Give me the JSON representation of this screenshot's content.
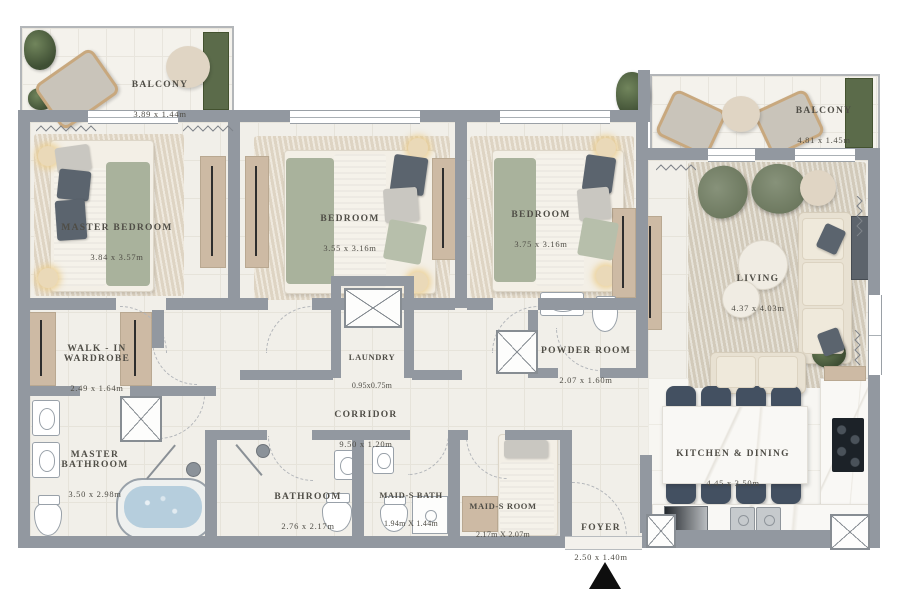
{
  "plan_type": "apartment-floor-plan",
  "rooms": {
    "balcony1": {
      "label": "BALCONY",
      "dims": "3.89 x 1.44m"
    },
    "master_bedroom": {
      "label": "MASTER BEDROOM",
      "dims": "3.84 x 3.57m"
    },
    "bedroom2": {
      "label": "BEDROOM",
      "dims": "3.55 x 3.16m"
    },
    "bedroom3": {
      "label": "BEDROOM",
      "dims": "3.75 x 3.16m"
    },
    "balcony2": {
      "label": "BALCONY",
      "dims": "4.81 x 1.45m"
    },
    "living": {
      "label": "LIVING",
      "dims": "4.37 x 4.03m"
    },
    "walkin": {
      "label": "WALK - IN WARDROBE",
      "dims": "2.49 x 1.64m"
    },
    "laundry": {
      "label": "LAUNDRY",
      "dims": "0.95x0.75m"
    },
    "powder": {
      "label": "POWDER ROOM",
      "dims": "2.07 x 1.60m"
    },
    "corridor": {
      "label": "CORRIDOR",
      "dims": "9.50 x 1.20m"
    },
    "master_bath": {
      "label": "MASTER BATHROOM",
      "dims": "3.50 x 2.98m"
    },
    "bathroom": {
      "label": "BATHROOM",
      "dims": "2.76 x 2.17m"
    },
    "maids_bath": {
      "label": "MAID-S BATH",
      "dims": "1.94m X 1.44m"
    },
    "maids_room": {
      "label": "MAID-S ROOM",
      "dims": "2.17m X 2.07m"
    },
    "kitchen": {
      "label": "KITCHEN & DINING",
      "dims": "4.45 x 3.50m"
    },
    "foyer": {
      "label": "FOYER",
      "dims": "2.50 x 1.40m"
    }
  },
  "icons": {
    "entrance_arrow": "up-triangle"
  },
  "colors": {
    "wall": "#9298a0",
    "floor": "#f1efe9",
    "rug": "#e6ddcd",
    "sage": "#a9b29c",
    "plant": "#4f5f3f",
    "wood": "#cdbaa4",
    "chair_dark": "#435061",
    "water": "#b6cedd",
    "label_text": "#4f4d46",
    "marble": "#f9f8f5",
    "arrow": "#0e0e0e"
  }
}
